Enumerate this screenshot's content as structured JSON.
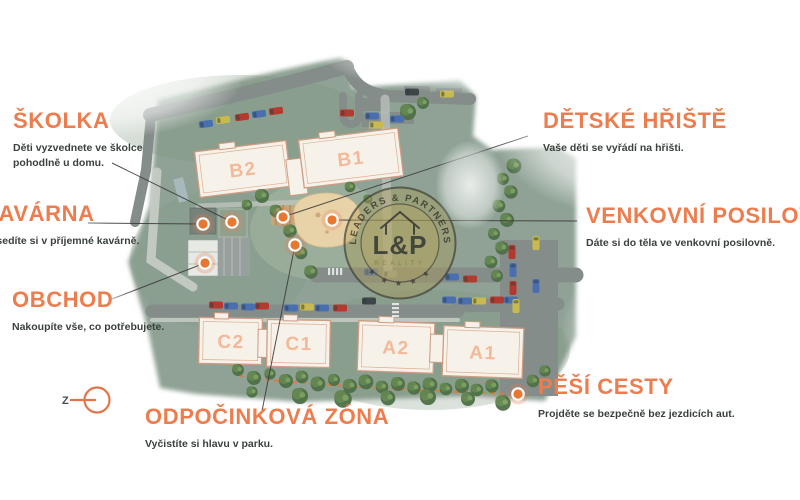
{
  "callouts": {
    "skolka": {
      "title": "ŠKOLKA",
      "description": "Děti vyzvednete ve školce pohodlně u domu."
    },
    "kavarna": {
      "title": "KAVÁRNA",
      "description": "Posedíte si v příjemné kavárně."
    },
    "obchod": {
      "title": "OBCHOD",
      "description": "Nakoupíte vše, co potřebujete."
    },
    "detske_hriste": {
      "title": "DĚTSKÉ HŘIŠTĚ",
      "description": "Vaše děti se vyřádí na hřišti."
    },
    "venkovni_posilovna": {
      "title": "VENKOVNÍ POSILOVNA",
      "description": "Dáte si do těla ve venkovní posilovně."
    },
    "pesi_cesty": {
      "title": "PĚŠÍ CESTY",
      "description": "Projděte se bezpečně bez jezdicích aut."
    },
    "odpocinkova_zona": {
      "title": "ODPOČINKOVÁ ZÓNA",
      "description": "Vyčistíte si hlavu v parku."
    }
  },
  "map": {
    "buildings": [
      {
        "label": "B2"
      },
      {
        "label": "B1"
      },
      {
        "label": "C2"
      },
      {
        "label": "C1"
      },
      {
        "label": "A2"
      },
      {
        "label": "A1"
      }
    ]
  },
  "logo": {
    "ring_text": "LEADERS & PARTNERS",
    "monogram": "L&P",
    "subtitle": "REALITY",
    "stars": "★ ★ ★ ★ ★"
  },
  "compass": {
    "letter": "Z"
  },
  "colors": {
    "accent_orange": "#ED7D4E",
    "marker_orange": "#E8772F",
    "site_green": "#8FA295",
    "road_gray": "#868E8B",
    "building_cream": "#F6F2E9",
    "building_outline": "#CF9B82",
    "text_dark": "#3A403D",
    "logo_gold": "#AD9B55"
  }
}
